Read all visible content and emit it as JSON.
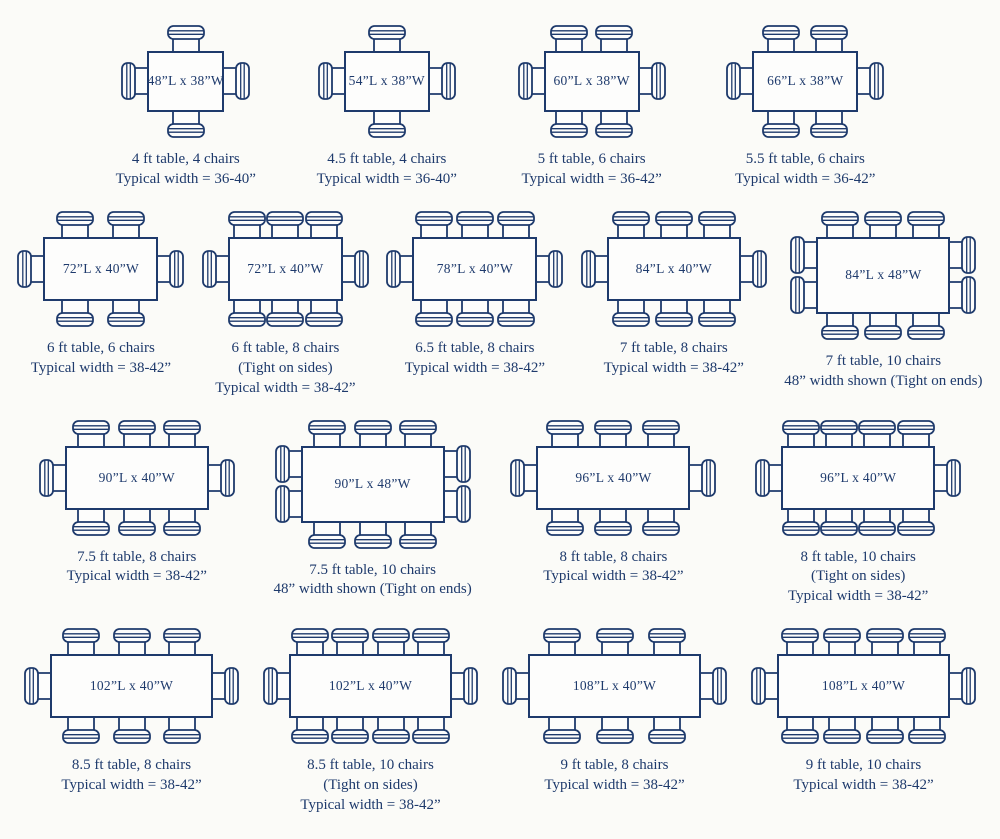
{
  "palette": {
    "line_color": "#1e3a6c",
    "background": "#fbfbf8",
    "table_fill": "#fdfdfc"
  },
  "rows": [
    {
      "tables": [
        {
          "label": "48”L x 38”W",
          "length_in": 48,
          "width_in": 38,
          "chairs": {
            "top": 1,
            "bottom": 1,
            "left": 1,
            "right": 1
          },
          "caption": [
            "4 ft table, 4 chairs",
            "Typical width = 36-40”"
          ]
        },
        {
          "label": "54”L x 38”W",
          "length_in": 54,
          "width_in": 38,
          "chairs": {
            "top": 1,
            "bottom": 1,
            "left": 1,
            "right": 1
          },
          "caption": [
            "4.5 ft table, 4 chairs",
            "Typical width = 36-40”"
          ]
        },
        {
          "label": "60”L x 38”W",
          "length_in": 60,
          "width_in": 38,
          "chairs": {
            "top": 2,
            "bottom": 2,
            "left": 1,
            "right": 1
          },
          "caption": [
            "5 ft table, 6 chairs",
            "Typical width = 36-42”"
          ]
        },
        {
          "label": "66”L x 38”W",
          "length_in": 66,
          "width_in": 38,
          "chairs": {
            "top": 2,
            "bottom": 2,
            "left": 1,
            "right": 1
          },
          "caption": [
            "5.5 ft table, 6 chairs",
            "Typical width = 36-42”"
          ]
        }
      ]
    },
    {
      "tables": [
        {
          "label": "72”L x 40”W",
          "length_in": 72,
          "width_in": 40,
          "chairs": {
            "top": 2,
            "bottom": 2,
            "left": 1,
            "right": 1
          },
          "caption": [
            "6 ft table, 6 chairs",
            "Typical width = 38-42”"
          ]
        },
        {
          "label": "72”L x 40”W",
          "length_in": 72,
          "width_in": 40,
          "chairs": {
            "top": 3,
            "bottom": 3,
            "left": 1,
            "right": 1
          },
          "caption": [
            "6 ft table, 8 chairs",
            "(Tight on sides)",
            "Typical width = 38-42”"
          ]
        },
        {
          "label": "78”L x 40”W",
          "length_in": 78,
          "width_in": 40,
          "chairs": {
            "top": 3,
            "bottom": 3,
            "left": 1,
            "right": 1
          },
          "caption": [
            "6.5 ft table, 8 chairs",
            "Typical width = 38-42”"
          ]
        },
        {
          "label": "84”L x 40”W",
          "length_in": 84,
          "width_in": 40,
          "chairs": {
            "top": 3,
            "bottom": 3,
            "left": 1,
            "right": 1
          },
          "caption": [
            "7 ft table, 8 chairs",
            "Typical width = 38-42”"
          ]
        },
        {
          "label": "84”L x 48”W",
          "length_in": 84,
          "width_in": 48,
          "chairs": {
            "top": 3,
            "bottom": 3,
            "left": 2,
            "right": 2
          },
          "caption": [
            "7 ft table, 10 chairs",
            "48” width shown (Tight on ends)"
          ]
        }
      ]
    },
    {
      "tables": [
        {
          "label": "90”L x 40”W",
          "length_in": 90,
          "width_in": 40,
          "chairs": {
            "top": 3,
            "bottom": 3,
            "left": 1,
            "right": 1
          },
          "caption": [
            "7.5 ft table, 8 chairs",
            "Typical width = 38-42”"
          ]
        },
        {
          "label": "90”L x 48”W",
          "length_in": 90,
          "width_in": 48,
          "chairs": {
            "top": 3,
            "bottom": 3,
            "left": 2,
            "right": 2
          },
          "caption": [
            "7.5 ft table, 10 chairs",
            "48” width shown (Tight on ends)"
          ]
        },
        {
          "label": "96”L x 40”W",
          "length_in": 96,
          "width_in": 40,
          "chairs": {
            "top": 3,
            "bottom": 3,
            "left": 1,
            "right": 1
          },
          "caption": [
            "8 ft table, 8 chairs",
            "Typical width = 38-42”"
          ]
        },
        {
          "label": "96”L x 40”W",
          "length_in": 96,
          "width_in": 40,
          "chairs": {
            "top": 4,
            "bottom": 4,
            "left": 1,
            "right": 1
          },
          "caption": [
            "8 ft table, 10 chairs",
            "(Tight on sides)",
            "Typical width = 38-42”"
          ]
        }
      ]
    },
    {
      "tables": [
        {
          "label": "102”L x 40”W",
          "length_in": 102,
          "width_in": 40,
          "chairs": {
            "top": 3,
            "bottom": 3,
            "left": 1,
            "right": 1
          },
          "caption": [
            "8.5 ft table, 8 chairs",
            "Typical width = 38-42”"
          ]
        },
        {
          "label": "102”L x 40”W",
          "length_in": 102,
          "width_in": 40,
          "chairs": {
            "top": 4,
            "bottom": 4,
            "left": 1,
            "right": 1
          },
          "caption": [
            "8.5 ft table, 10 chairs",
            "(Tight on sides)",
            "Typical width = 38-42”"
          ]
        },
        {
          "label": "108”L x 40”W",
          "length_in": 108,
          "width_in": 40,
          "chairs": {
            "top": 3,
            "bottom": 3,
            "left": 1,
            "right": 1
          },
          "caption": [
            "9 ft table, 8 chairs",
            "Typical width = 38-42”"
          ]
        },
        {
          "label": "108”L x 40”W",
          "length_in": 108,
          "width_in": 40,
          "chairs": {
            "top": 4,
            "bottom": 4,
            "left": 1,
            "right": 1
          },
          "caption": [
            "9 ft table, 10 chairs",
            "Typical width = 38-42”"
          ]
        }
      ]
    }
  ]
}
